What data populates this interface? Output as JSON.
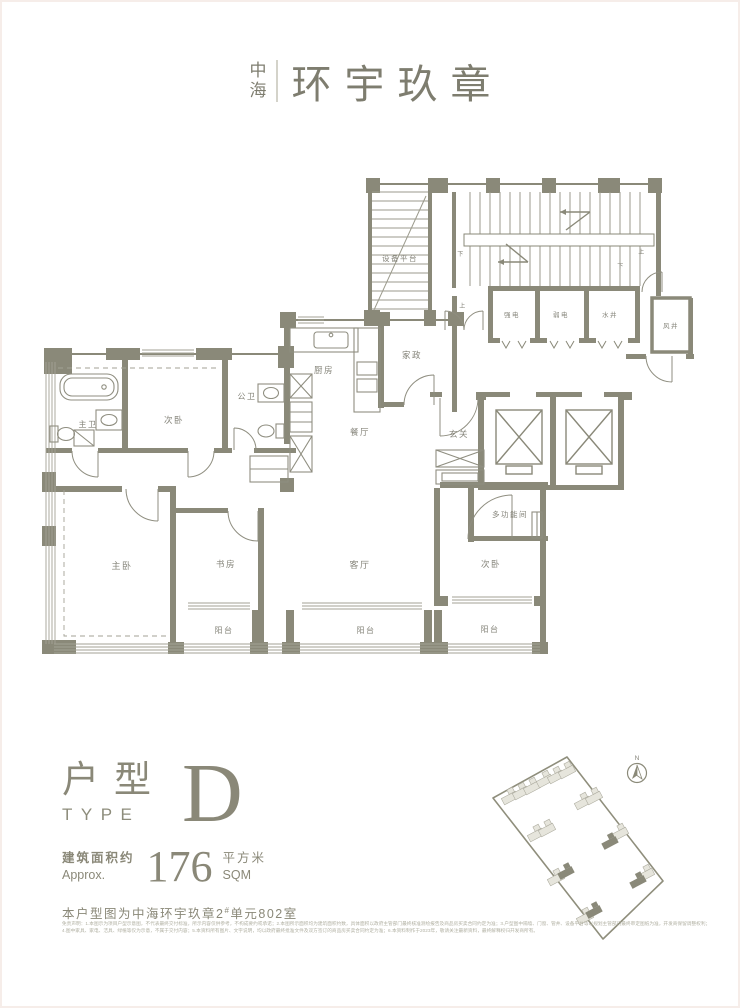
{
  "logo": {
    "brand_top": "中",
    "brand_bottom": "海",
    "name": "环宇玖章"
  },
  "plan": {
    "rooms": {
      "equipment_platform": "设备平台",
      "strong_electric": "强电",
      "weak_electric": "弱电",
      "water_shaft": "水井",
      "air_shaft": "风井",
      "kitchen": "厨房",
      "housekeeping": "家政",
      "dining": "餐厅",
      "foyer": "玄关",
      "master_bath": "主卫",
      "public_bath": "公卫",
      "bedroom2": "次卧",
      "master_bedroom": "主卧",
      "study": "书房",
      "living": "客厅",
      "multi_function": "多功能间",
      "balcony": "阳台"
    },
    "stairs": {
      "up": "上",
      "down": "下"
    }
  },
  "title_block": {
    "type_cn": "户型",
    "type_en": "TYPE",
    "type_letter": "D",
    "area_label_cn": "建筑面积约",
    "area_label_en": "Approx.",
    "area_value": "176",
    "area_unit_cn": "平方米",
    "area_unit_en": "SQM",
    "caption_pre": "本户型图为中海环宇玖章2",
    "caption_sup": "#",
    "caption_post": "单元802室"
  },
  "site_plan": {
    "north": "N",
    "buildings": [
      {
        "x": 25,
        "y": 50,
        "dark": false
      },
      {
        "x": 36,
        "y": 45,
        "dark": false
      },
      {
        "x": 47,
        "y": 40,
        "dark": false
      },
      {
        "x": 60,
        "y": 33,
        "dark": false
      },
      {
        "x": 71,
        "y": 29,
        "dark": false
      },
      {
        "x": 82,
        "y": 24,
        "dark": false
      },
      {
        "x": 98,
        "y": 55,
        "dark": false
      },
      {
        "x": 109,
        "y": 50,
        "dark": false
      },
      {
        "x": 51,
        "y": 87,
        "dark": false
      },
      {
        "x": 62,
        "y": 82,
        "dark": false
      },
      {
        "x": 135,
        "y": 86,
        "dark": false
      },
      {
        "x": 125,
        "y": 95,
        "dark": true
      },
      {
        "x": 71,
        "y": 131,
        "dark": false
      },
      {
        "x": 81,
        "y": 125,
        "dark": true
      },
      {
        "x": 161,
        "y": 127,
        "dark": false
      },
      {
        "x": 153,
        "y": 134,
        "dark": true
      },
      {
        "x": 100,
        "y": 170,
        "dark": false
      },
      {
        "x": 109,
        "y": 164,
        "dark": true
      }
    ]
  },
  "disclaimer": {
    "line1": "免责声明：1.本图示为项目户型示意图，不代表最终交付标准，所示内容仅供参考，不构成要约或承诺；2.本图所示面积均为建筑面积约数，具体面积以政府主管部门最终核准测绘报告及商品房买卖合同约定为准；3.户型图中隔墙、门窗、管井、设备平台等以规划主管部门最终审定图纸为准，开发商保留调整权利；",
    "line2": "4.图中家具、家电、洁具、绿植等仅为示意，不属于交付内容；5.本资料所有图片、文字说明，均以政府最终批准文件及双方签订的商品房买卖合同约定为准；6.本资料制作于2023年，敬请关注最新资料，最终解释权归开发商所有。"
  },
  "colors": {
    "accent": "#8a8978",
    "wall": "#8a8979",
    "line_light": "#b7b6a8"
  }
}
